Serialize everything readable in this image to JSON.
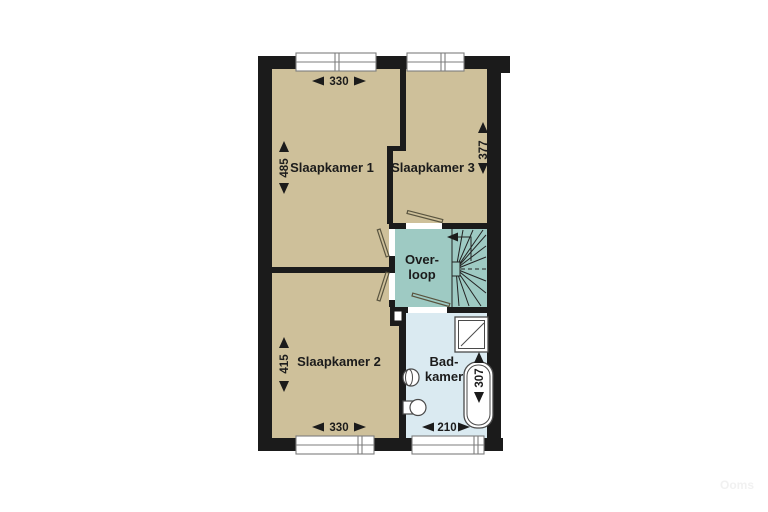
{
  "floorplan": {
    "rooms": {
      "slaapkamer1": {
        "label": "Slaapkamer 1",
        "width": "330",
        "depth": "485"
      },
      "slaapkamer3": {
        "label": "Slaapkamer 3",
        "depth": "377"
      },
      "slaapkamer2": {
        "label": "Slaapkamer 2",
        "width": "330",
        "depth": "415"
      },
      "overloop": {
        "label_line1": "Over-",
        "label_line2": "loop"
      },
      "badkamer": {
        "label_line1": "Bad-",
        "label_line2": "kamer",
        "width": "210",
        "depth": "307"
      }
    },
    "colors": {
      "bedroom_fill": "#cec09a",
      "landing_fill": "#9ecac3",
      "bathroom_fill": "#daeaf1",
      "wall": "#1b1b1b"
    },
    "fixtures": {
      "stairs": "winder-staircase",
      "shower": "shower",
      "bathtub": "bathtub",
      "toilet": "toilet",
      "sink": "sink",
      "shaft": "duct-shaft"
    },
    "watermark": "Ooms"
  }
}
